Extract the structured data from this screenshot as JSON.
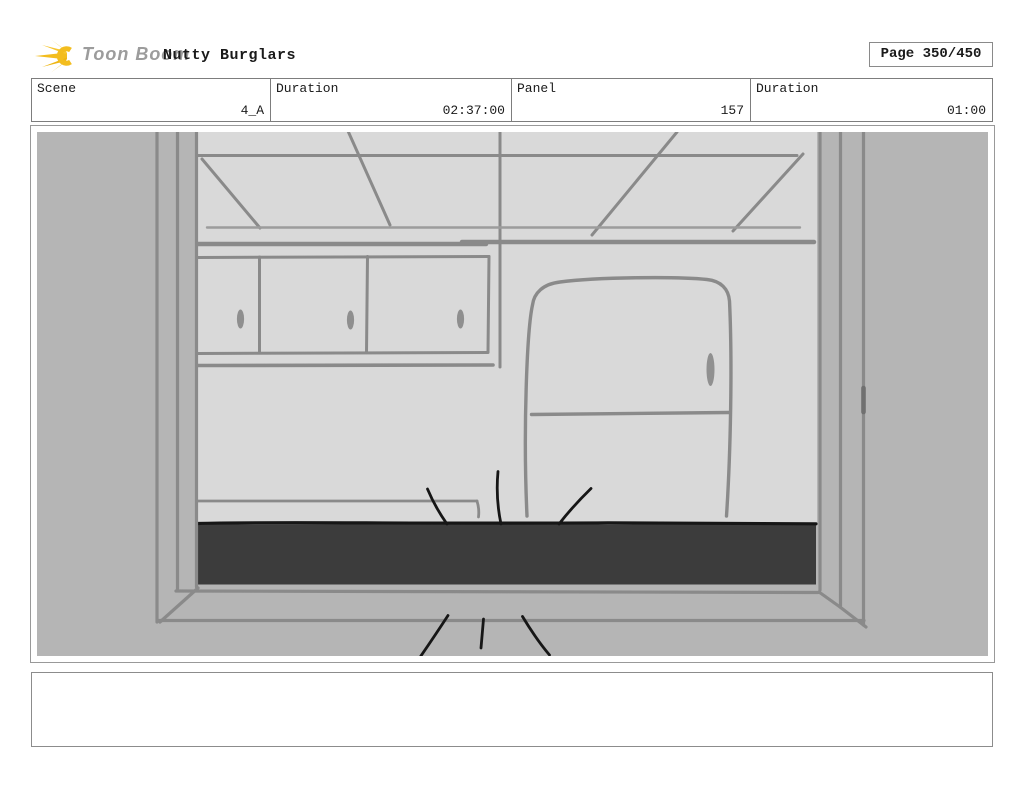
{
  "header": {
    "brand": "Toon Boom",
    "title": "Nutty Burglars",
    "page_label": "Page 350/450",
    "logo_color": "#f3bd1e",
    "brand_text_color": "#9c9c9c"
  },
  "info_table": {
    "cells": [
      {
        "label": "Scene",
        "value": "4_A"
      },
      {
        "label": "Duration",
        "value": "02:37:00"
      },
      {
        "label": "Panel",
        "value": "157"
      },
      {
        "label": "Duration",
        "value": "01:00"
      }
    ]
  },
  "storyboard_panel": {
    "scene_description": "Hand-drawn storyboard sketch: kitchen interior viewed through a window frame - ceiling beams in perspective, three upper cabinet doors with oval handles, refrigerator with handle, dark countertop with black impact/motion lines above the counter and below the window sill",
    "colors": {
      "outside_frame": "#b5b5b5",
      "interior_wall": "#d9d9d9",
      "sketch_line": "#8a8a8a",
      "soft_line": "#9c9c9c",
      "counter_fill": "#3c3c3c",
      "ink_line": "#161616"
    }
  },
  "caption": {
    "text": ""
  }
}
